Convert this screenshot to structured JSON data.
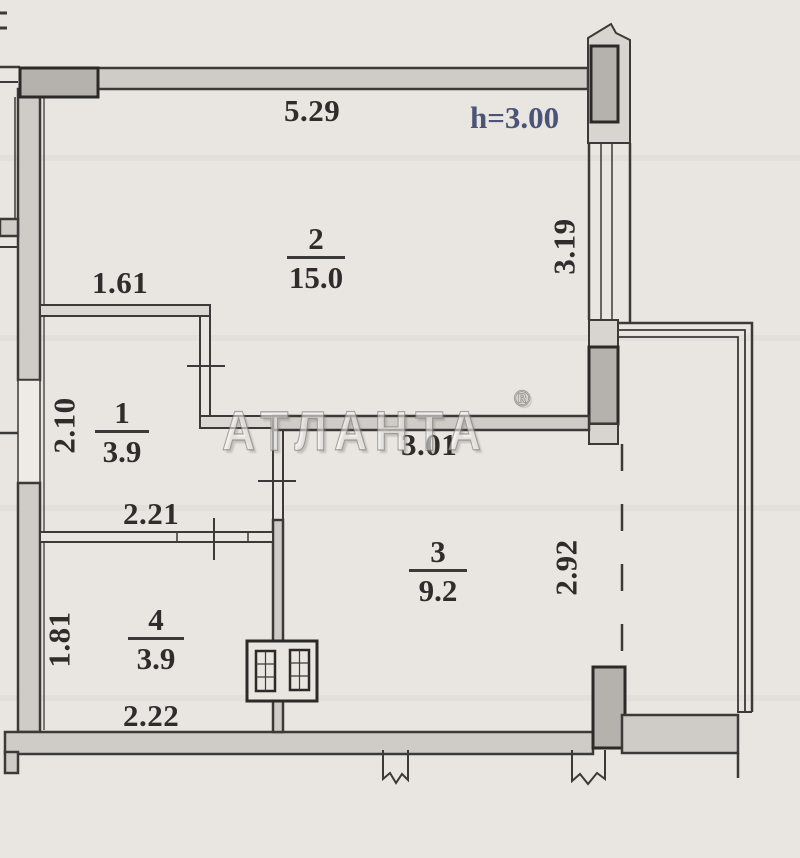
{
  "plan": {
    "ceiling_height_note": "h=3.00",
    "watermark": {
      "text": "АТЛАНТА",
      "registered_mark": "®"
    },
    "rooms": [
      {
        "number": "1",
        "area": "3.9"
      },
      {
        "number": "2",
        "area": "15.0"
      },
      {
        "number": "3",
        "area": "9.2"
      },
      {
        "number": "4",
        "area": "3.9"
      }
    ],
    "dimensions": {
      "room2_width_top": "5.29",
      "room2_depth_right": "3.19",
      "room1_width_top": "1.61",
      "room1_depth_left": "2.10",
      "hall_width_bottom": "2.21",
      "room3_width_top": "3.01",
      "room3_depth_right": "2.92",
      "room4_depth_left": "1.81",
      "room4_width_bottom": "2.22"
    },
    "colors": {
      "paper": "#e9e6e1",
      "wall_fill": "#cfccc7",
      "wall_dark_fill": "#b5b2ad",
      "line": "#3b3a38",
      "text": "#2e2d2b",
      "height_note": "#4b5377"
    }
  }
}
